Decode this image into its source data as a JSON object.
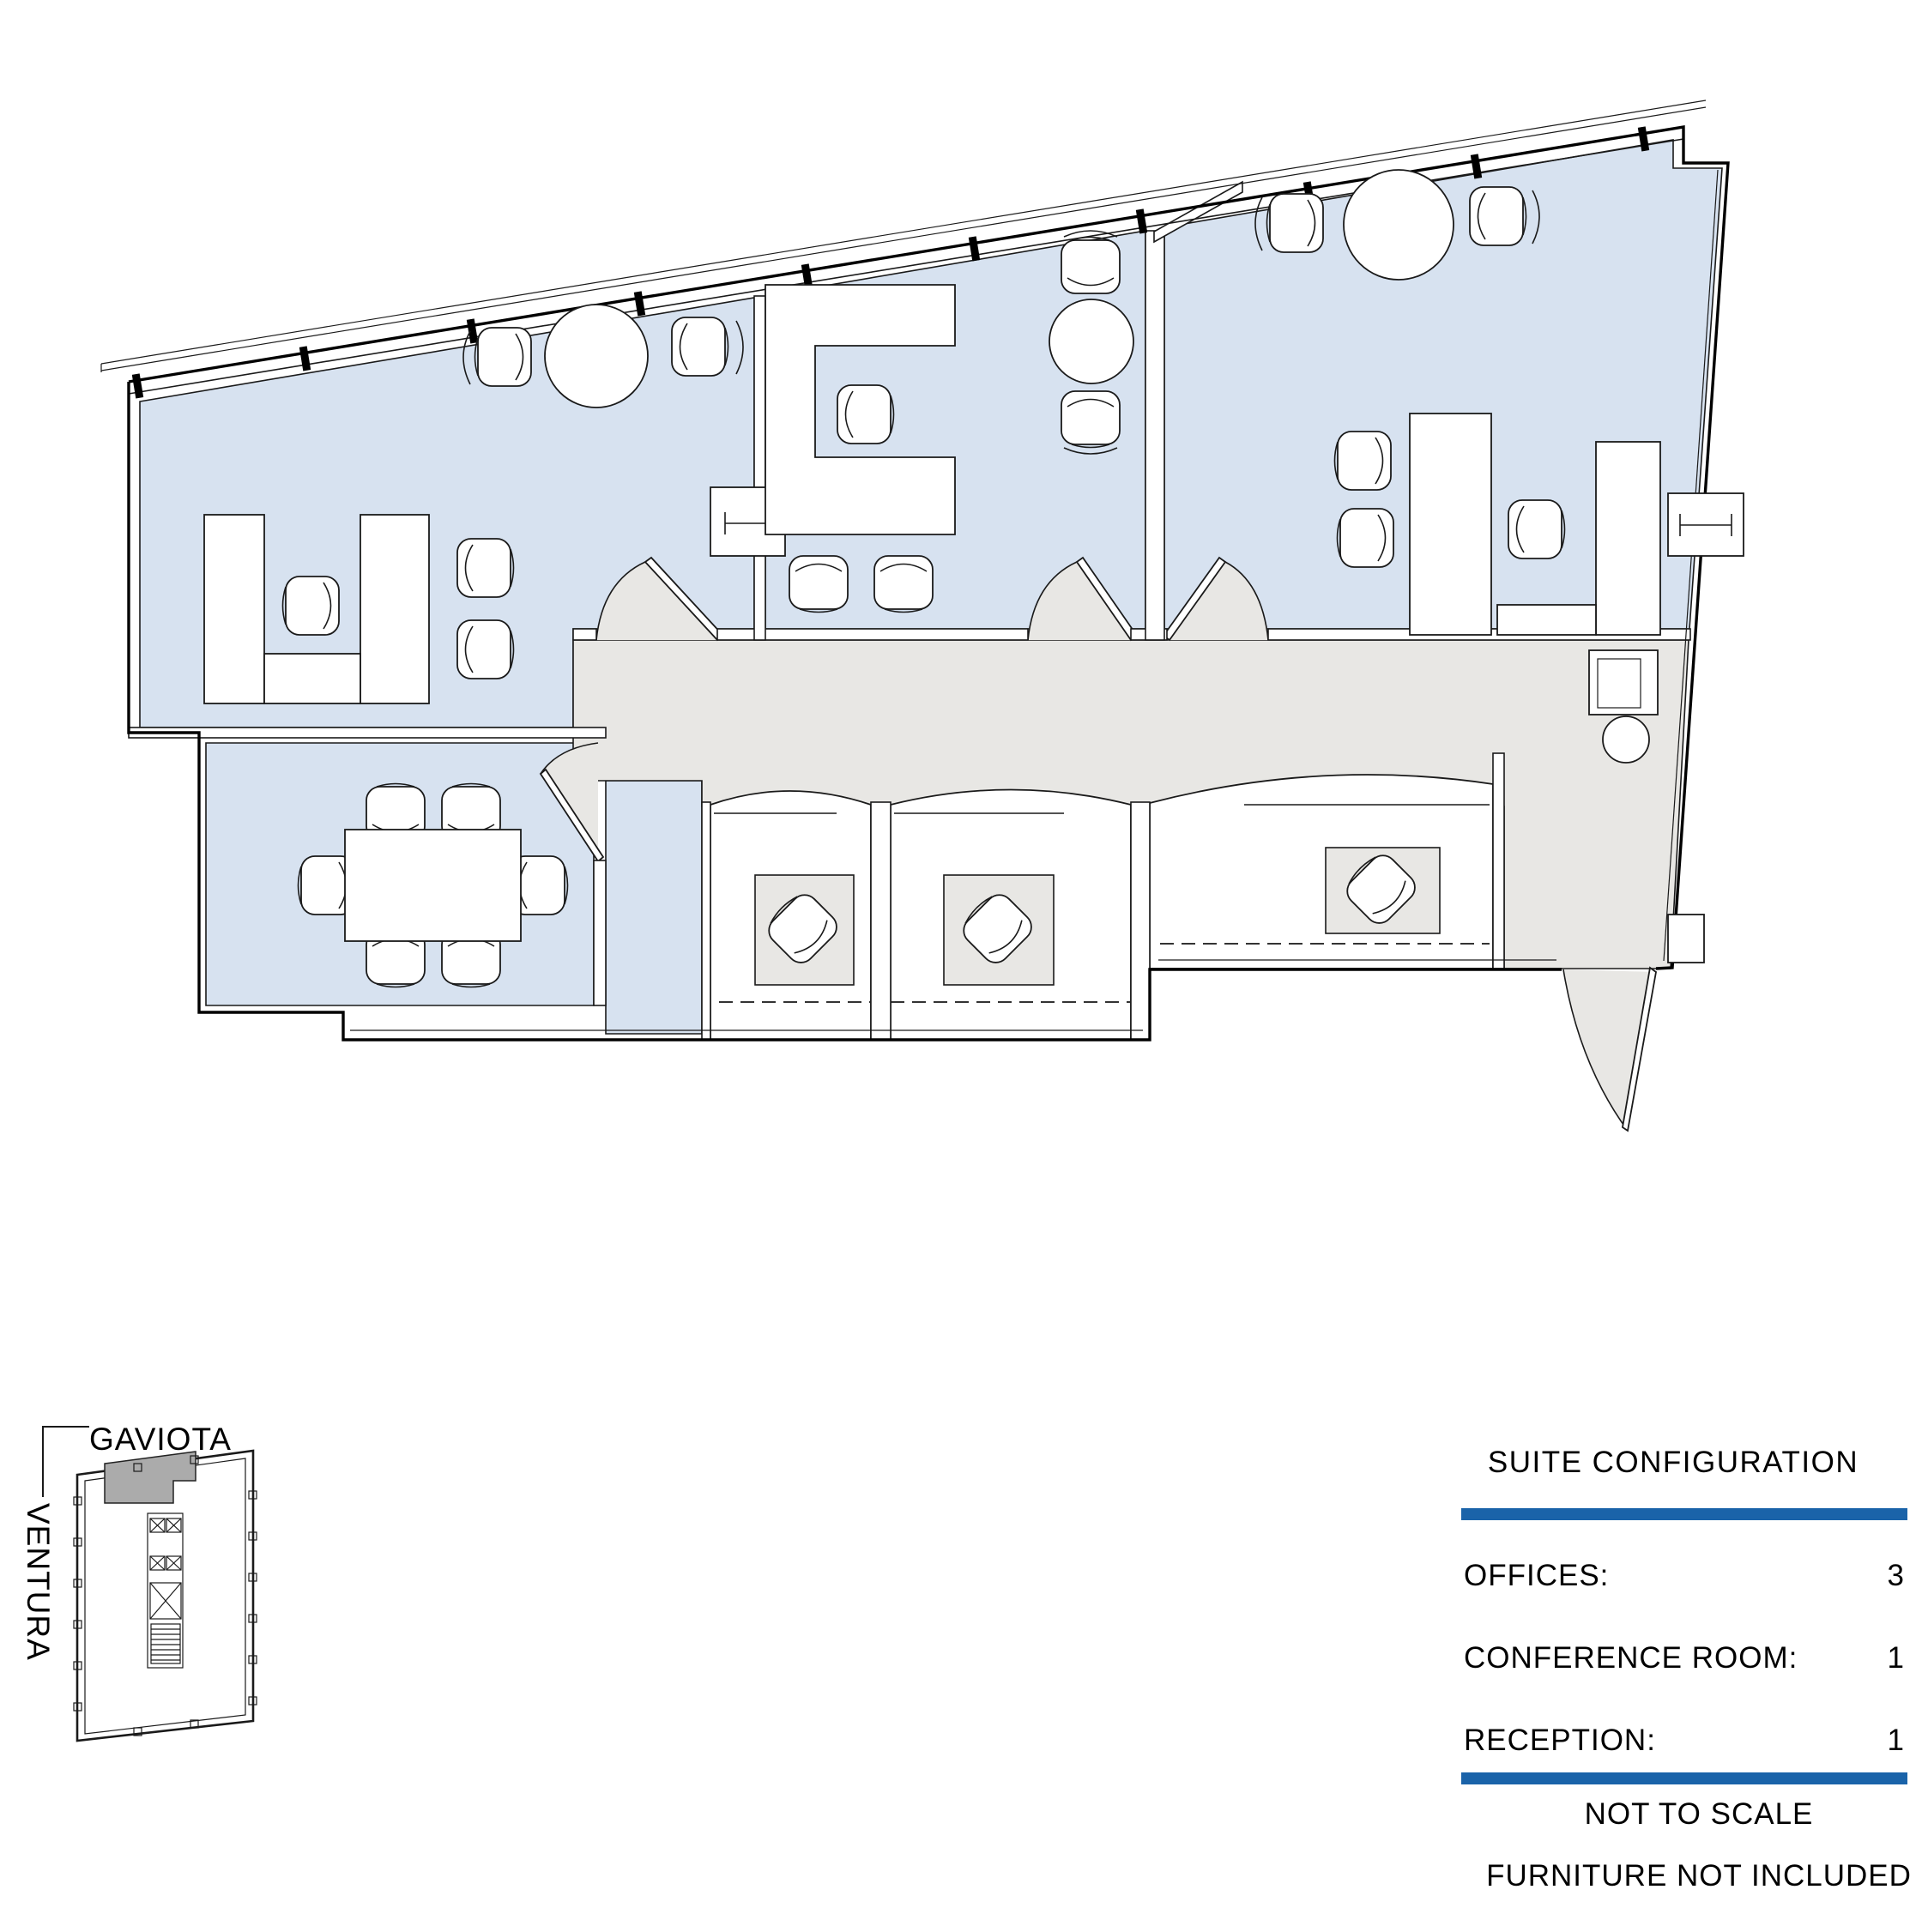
{
  "colors": {
    "room_fill": "#D7E2F0",
    "floor_fill": "#E8E7E4",
    "highlight_gray": "#ABABAB",
    "rule_blue": "#1A63A9"
  },
  "key_plan": {
    "street_top_label": "GAVIOTA",
    "street_side_label": "VENTURA"
  },
  "suite_configuration": {
    "title": "SUITE CONFIGURATION",
    "rows": [
      {
        "label": "OFFICES:",
        "value": "3"
      },
      {
        "label": "CONFERENCE ROOM:",
        "value": "1"
      },
      {
        "label": "RECEPTION:",
        "value": "1"
      }
    ],
    "footnotes": [
      "NOT TO SCALE",
      "FURNITURE NOT INCLUDED"
    ]
  }
}
